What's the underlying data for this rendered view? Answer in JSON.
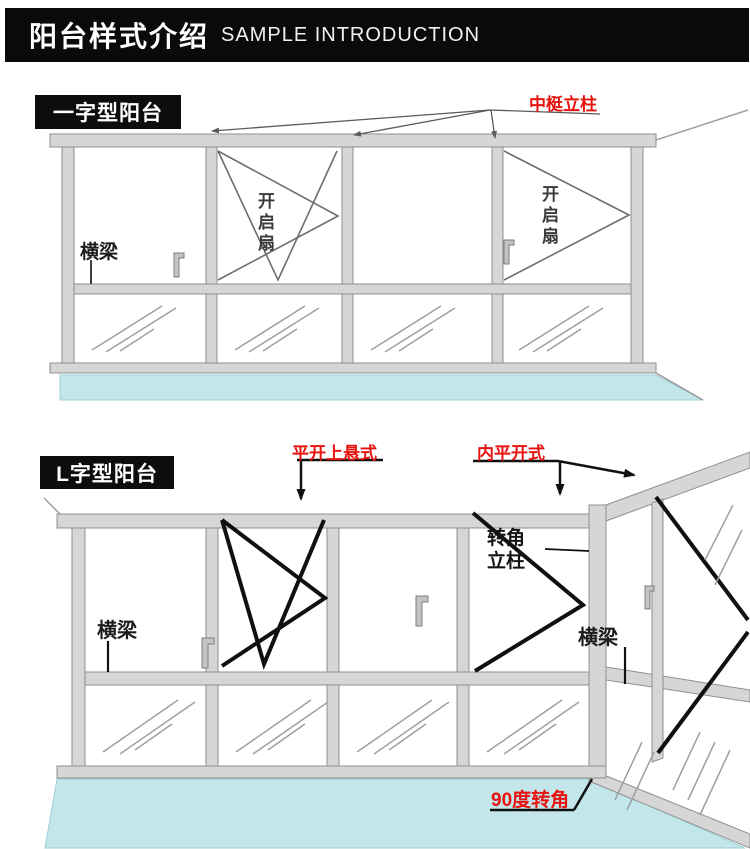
{
  "header": {
    "title_zh": "阳台样式介绍",
    "title_en": "SAMPLE INTRODUCTION"
  },
  "diagram1": {
    "badge": "一字型阳台",
    "labels": {
      "mullion_post": "中梃立柱",
      "beam": "横梁",
      "opening_sash_left": "开启扇",
      "opening_sash_right": "开启扇"
    }
  },
  "diagram2": {
    "badge": "L字型阳台",
    "labels": {
      "casement_top_hung": "平开上悬式",
      "inward_casement": "内平开式",
      "corner_post": "转角立柱",
      "beam_left": "横梁",
      "beam_right": "横梁",
      "corner_90deg": "90度转角"
    }
  },
  "colors": {
    "header_bg": "#0a0a0a",
    "badge_bg": "#0d0d0d",
    "accent_red": "#e8120e",
    "frame_fill": "#d6d6d6",
    "frame_stroke": "#8f8f8f",
    "floor_fill": "#c2e6ea",
    "sash_line_thin": "#6e6e6e",
    "sash_line_bold": "#101010",
    "glass_hatch": "#9aa0a4"
  }
}
